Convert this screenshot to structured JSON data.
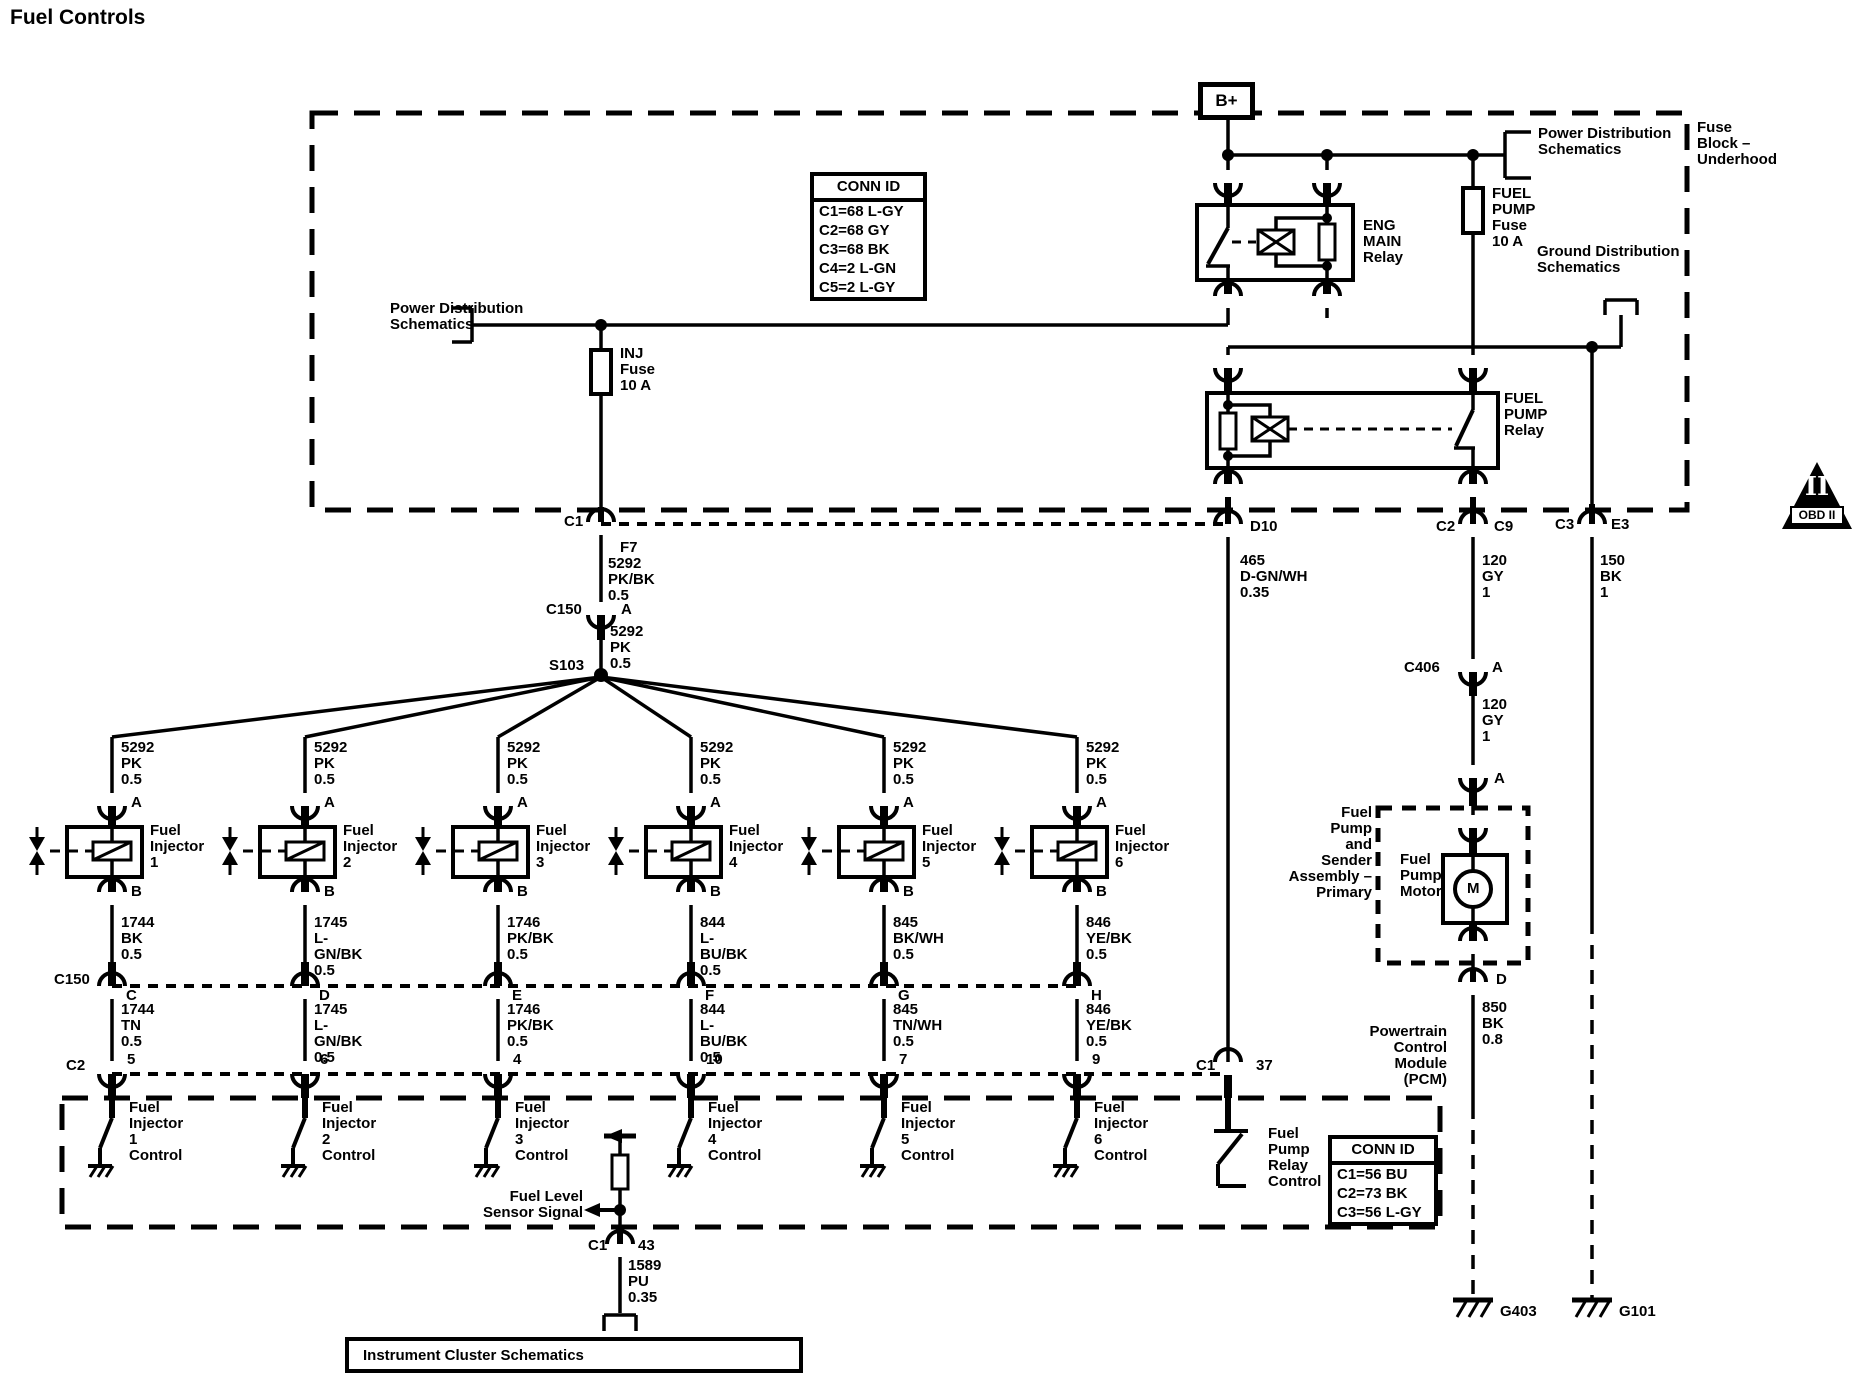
{
  "title": "Fuel Controls",
  "fuse_block": {
    "bplus": "B+",
    "label": "Fuse\nBlock –\nUnderhood",
    "conn_id": {
      "title": "CONN ID",
      "rows": [
        "C1=68 L-GY",
        "C2=68 GY",
        "C3=68 BK",
        "C4=2 L-GN",
        "C5=2 L-GY"
      ]
    },
    "eng_main_relay": "ENG\nMAIN\nRelay",
    "fuel_pump_fuse": "FUEL\nPUMP\nFuse\n10 A",
    "fuel_pump_relay": "FUEL\nPUMP\nRelay",
    "inj_fuse": "INJ\nFuse\n10 A",
    "power_dist_left": "Power Distribution\nSchematics",
    "power_dist_right": "Power Distribution\nSchematics",
    "ground_dist": "Ground Distribution\nSchematics"
  },
  "obd2": {
    "numeral": "II",
    "label": "OBD II"
  },
  "feed": {
    "c1": "C1",
    "f7": "F7",
    "wire_pkbk": "5292\nPK/BK\n0.5",
    "c150": "C150",
    "pin_a": "A",
    "wire_pk": "5292\nPK\n0.5",
    "s103": "S103"
  },
  "bus": {
    "c150_label": "C150",
    "c2_label": "C2"
  },
  "injectors": [
    {
      "wire_top": "5292\nPK\n0.5",
      "pin_top": "A",
      "name": "Fuel\nInjector\n1",
      "pin_bottom": "B",
      "wire_upper": "1744\nBK\n0.5",
      "c150_pin": "C",
      "wire_lower": "1744\nTN\n0.5",
      "c2_pin": "5",
      "control": "Fuel\nInjector\n1\nControl"
    },
    {
      "wire_top": "5292\nPK\n0.5",
      "pin_top": "A",
      "name": "Fuel\nInjector\n2",
      "pin_bottom": "B",
      "wire_upper": "1745\nL-GN/BK\n0.5",
      "c150_pin": "D",
      "wire_lower": "1745\nL-GN/BK\n0.5",
      "c2_pin": "6",
      "control": "Fuel\nInjector\n2\nControl"
    },
    {
      "wire_top": "5292\nPK\n0.5",
      "pin_top": "A",
      "name": "Fuel\nInjector\n3",
      "pin_bottom": "B",
      "wire_upper": "1746\nPK/BK\n0.5",
      "c150_pin": "E",
      "wire_lower": "1746\nPK/BK\n0.5",
      "c2_pin": "4",
      "control": "Fuel\nInjector\n3\nControl"
    },
    {
      "wire_top": "5292\nPK\n0.5",
      "pin_top": "A",
      "name": "Fuel\nInjector\n4",
      "pin_bottom": "B",
      "wire_upper": "844\nL-BU/BK\n0.5",
      "c150_pin": "F",
      "wire_lower": "844\nL-BU/BK\n0.5",
      "c2_pin": "10",
      "control": "Fuel\nInjector\n4\nControl"
    },
    {
      "wire_top": "5292\nPK\n0.5",
      "pin_top": "A",
      "name": "Fuel\nInjector\n5",
      "pin_bottom": "B",
      "wire_upper": "845\nBK/WH\n0.5",
      "c150_pin": "G",
      "wire_lower": "845\nTN/WH\n0.5",
      "c2_pin": "7",
      "control": "Fuel\nInjector\n5\nControl"
    },
    {
      "wire_top": "5292\nPK\n0.5",
      "pin_top": "A",
      "name": "Fuel\nInjector\n6",
      "pin_bottom": "B",
      "wire_upper": "846\nYE/BK\n0.5",
      "c150_pin": "H",
      "wire_lower": "846\nYE/BK\n0.5",
      "c2_pin": "9",
      "control": "Fuel\nInjector\n6\nControl"
    }
  ],
  "pcm": {
    "label": "Powertrain\nControl\nModule\n(PCM)",
    "c1": "C1",
    "pin37": "37",
    "relay_control": "Fuel\nPump\nRelay\nControl",
    "conn_id": {
      "title": "CONN ID",
      "rows": [
        "C1=56 BU",
        "C2=73 BK",
        "C3=56 L-GY"
      ]
    },
    "fuel_level": "Fuel Level\nSensor Signal"
  },
  "fuel_level_branch": {
    "c1": "C1",
    "pin43": "43",
    "wire": "1589\nPU\n0.35",
    "instrument": "Instrument Cluster Schematics"
  },
  "relay_branch": {
    "d10": "D10",
    "wire": "465\nD-GN/WH\n0.35"
  },
  "pump_branch": {
    "c2": "C2",
    "c9": "C9",
    "wire1": "120\nGY\n1",
    "c406": "C406",
    "pin_a1": "A",
    "wire2": "120\nGY\n1",
    "pin_a2": "A",
    "assembly": "Fuel\nPump\nand\nSender\nAssembly –\nPrimary",
    "motor": "Fuel\nPump\nMotor",
    "m": "M",
    "pin_d": "D",
    "wire3": "850\nBK\n0.8",
    "g403": "G403"
  },
  "ground_branch": {
    "c3": "C3",
    "e3": "E3",
    "wire": "150\nBK\n1",
    "g101": "G101"
  }
}
